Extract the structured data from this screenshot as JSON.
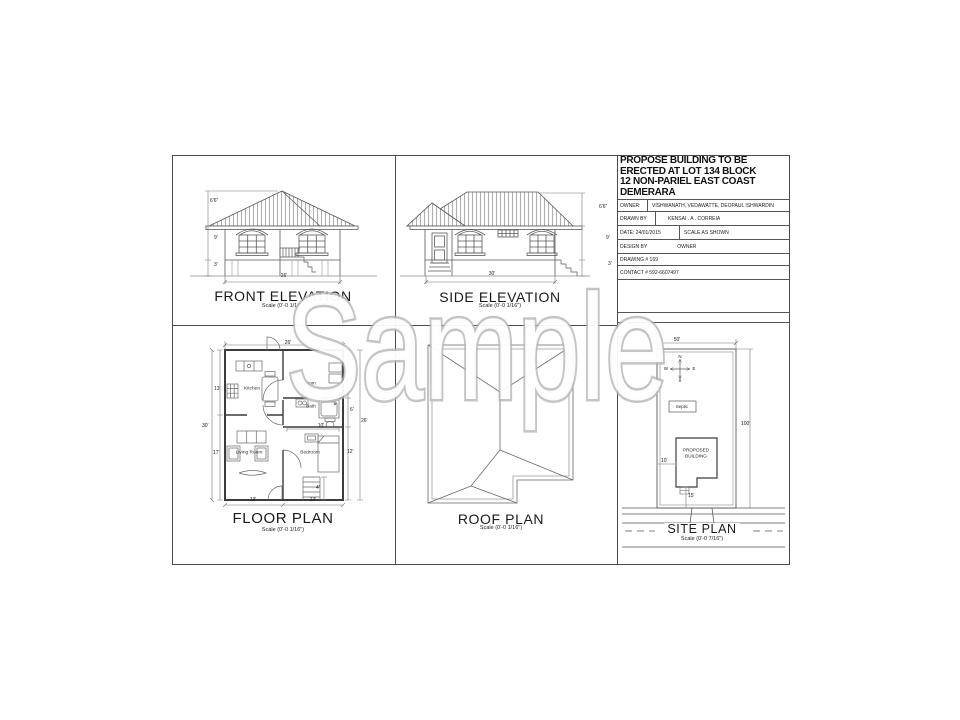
{
  "watermark": "Sample",
  "sheet": {
    "title_block": {
      "title_lines": [
        "PROPOSE BUILDING TO BE",
        "ERECTED AT LOT 134 BLOCK",
        "12 NON-PARIEL EAST COAST",
        "DEMERARA"
      ],
      "owner_label": "OWNER:",
      "owner_value": "VISHWANATH, VEDAWATTE, DEOPAUL ISHWARDIN",
      "drawn_by_label": "DRAWN BY",
      "drawn_by_value": "KENSAI . A . CORREIA",
      "date": "DATE: 24/01/2015",
      "scale_note": "SCALE AS SHOWN",
      "design_by_label": "DESIGN BY",
      "design_by_value": "OWNER",
      "drawing_number": "DRAWING #   169",
      "contact": "CONTACT # 592-6607497"
    },
    "front_elevation": {
      "title": "FRONT ELEVATION",
      "scale": "Scale (0'-0 1/16\")",
      "dim_roof": "6'6\"",
      "dim_wall": "9'",
      "dim_base": "3'",
      "dim_width": "26'"
    },
    "side_elevation": {
      "title": "SIDE ELEVATION",
      "scale": "Scale (0'-0 1/16\")",
      "dim_roof": "6'6\"",
      "dim_wall": "9'",
      "dim_base": "3'",
      "dim_width": "30'"
    },
    "floor_plan": {
      "title": "FLOOR PLAN",
      "scale": "Scale (0'-0 1/16\")",
      "rooms": {
        "kitchen": "Kitchen",
        "bedroom1": "Bedroom",
        "bath": "Bath",
        "living": "Living Room",
        "bedroom2": "Bedroom"
      },
      "dims": {
        "top": "26'",
        "left_upper": "13'",
        "left_total": "30'",
        "left_lower": "17'",
        "right_upper": "8'",
        "right_mid": "6'",
        "right_total": "26'",
        "right_lower": "12'",
        "interior": "10'",
        "bottom_left": "13'",
        "bottom_right": "13'",
        "steps": "4'"
      }
    },
    "roof_plan": {
      "title": "ROOF PLAN",
      "scale": "Scale (0'-0 1/16\")"
    },
    "site_plan": {
      "title": "SITE PLAN",
      "scale": "Scale (0'-0 7/16\")",
      "septic": "Septic",
      "building_line1": "PROPOSED",
      "building_line2": "BUILDING",
      "compass": {
        "n": "N",
        "s": "S",
        "e": "E",
        "w": "W"
      },
      "dims": {
        "width": "50'",
        "depth": "100'",
        "side": "10'",
        "front": "15'"
      }
    }
  }
}
